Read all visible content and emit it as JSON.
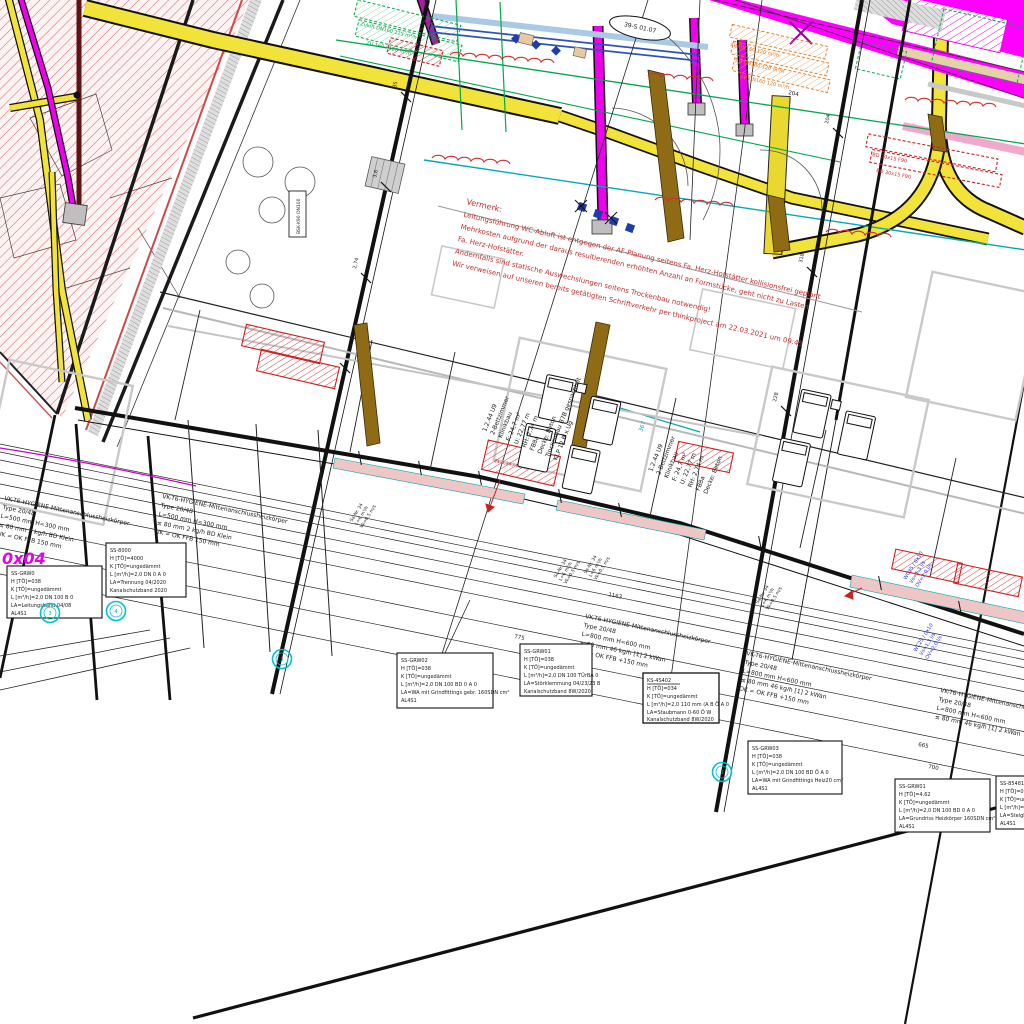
{
  "note": {
    "title": "Vermerk:",
    "lines": [
      "Leitungsführung WC-Abluft ist entgegen der AF-Planung seitens Fa. Herz-Hofstätter kollisionsfrei geplant",
      "Mehrkosten aufgrund der daraus resultierenden erhöhten Anzahl an Formstücke, geht nicht zu Lasten",
      "Fa. Herz-Hofstätter.",
      "Andernfalls sind statische Auswechslungen seitens Trockenbau notwendig!",
      "Wir verweisen auf unseren bereits getätigten Schriftverkehr per thinkproject am 22.03.2021 um 09:45"
    ]
  },
  "room_label": {
    "lines": [
      "1.2.44 U9",
      "2-Bettzimmer",
      "Klinikbau",
      "F: 24,7 m²",
      "U: 22,77 m",
      "RH: 2,74 m",
      "FB8a",
      "Decke: Beton",
      "Trockenbau B7B gespachtelt",
      "KLP 12 B x.Ug"
    ]
  },
  "radiator_spec": {
    "lines": [
      "VK-T6-HYGIENE-Mittenanschlussheizkörper",
      "Type 20/48",
      "L=800 mm H=600 mm",
      "≤ 80 mm  46 kg/h  [1] 2 kWan",
      "OK = OK FFB +150 mm"
    ]
  },
  "radiator_spec_alt": {
    "lines": [
      "VK-T6-HYGIENE-Mittenanschlussheizkörper",
      "Type 20/48",
      "L=500 mm H=300 mm",
      "≤ 80 mm  2 kg/h  BD Klein",
      "UK = OK FFB 150 mm"
    ]
  },
  "callouts": [
    {
      "lines": [
        "SS-GRW02",
        "H [TÖ]=038",
        "K [TÖ]=ungedämmt",
        "L [m³/h]=2,0 DN 100 BD 0 A 0",
        "LA=WA mit Grindfittings gebr. 160SDN cm²",
        "AL4S1"
      ]
    },
    {
      "lines": [
        "SS-GRW01",
        "H [TÖ]=038",
        "K [TÖ]=ungedämmt",
        "L [m³/h]=2,0 DN 100 TÜrBA 0",
        "LA=Störklemmung 04/23/23 B",
        "Kanalschutzband 8W/2020"
      ]
    },
    {
      "lines": [
        "KS-4S402",
        "H [TÖ]=034",
        "K [TÖ]=ungedämmt",
        "L [m³/h]=2,0 110 mm (A B Ö A 0",
        "LA=Staubmann 0-60 Ö W",
        "Kanalschutzband 8W/2020"
      ]
    },
    {
      "lines": [
        "SS-GRW03",
        "H [TÖ]=038",
        "K [TÖ]=ungedämmt",
        "L [m³/h]=2,0 DN 100 BD Ö A 0",
        "LA=WA mit Grindfittings Heiz20 cm²",
        "AL4S1"
      ]
    },
    {
      "lines": [
        "SS-GRW01",
        "H [TÖ]=4,62",
        "K [TÖ]=ungedämmt",
        "L [m³/h]=2,0 DN 100 BD 0 A 0",
        "LA=Grundriss Heizkörper 160SDN cm²",
        "AL4S1"
      ]
    },
    {
      "lines": [
        "SS-85481",
        "H [TÖ]=032",
        "K [TÖ]=ungedämmt",
        "L [m³/h]=2,0 DN 100 BD 0 A 0",
        "LA=Steigleitung Heizkörper 160 cm²",
        "AL4S1"
      ]
    },
    {
      "lines": [
        "SS-GRW0",
        "H [TÖ]=038",
        "K [TÖ]=ungedämmt",
        "L [m³/h]=2,0 DN 100 B 0",
        "LA=Leitungsband 04/08",
        "AL4S1"
      ]
    },
    {
      "lines": [
        "SS-8000",
        "H [TÖ]=4000",
        "K [TÖ]=ungedämmt",
        "L [m³/h]=2,0 DN 0 A 0",
        "LA=Trennung 04/2020",
        "Kanalschutzband 2020"
      ]
    }
  ],
  "flow_tag": {
    "lines": [
      "Sa-Nr. 34",
      "L=6 m³/h",
      "Vk=0,5 m/s"
    ]
  },
  "blue_note": {
    "lines": [
      "WC25 / 0x10",
      "Vs=1,3 l/s",
      "OV=2,0 l/s"
    ]
  },
  "labels": {
    "grid_bubble": "39-S 01.07",
    "riser": "0x04",
    "bsk": "BSK-K90 DN100",
    "green_tag_1": "Zuluft DN160 125 m³/h",
    "green_tag_2": "ZU 160 / 120 m³/h",
    "orange_tag": "AB DN160 120 m³/h",
    "red_tag": "21-0,34 / 60/40",
    "red_tag_2": "BD 30x15 F90",
    "teal_dim": "367"
  },
  "dims": {
    "a": "77",
    "b": "204",
    "c": "318",
    "d": "3,6",
    "e": "228",
    "f": "775",
    "g": "665",
    "h": "700",
    "i": "1163",
    "j": "35",
    "k": "2,74"
  },
  "bubbles": [
    "3",
    "4",
    "3",
    "5"
  ],
  "colors": {
    "duct_supply_yellow": "#f2e33a",
    "pipe_magenta": "#ff00ff",
    "note_red": "#c03030",
    "hatch_pink": "#d96b6b",
    "beam_brown": "#8f6b16",
    "marker_cyan": "#00c2ce",
    "line_green": "#00a84c",
    "line_blue": "#2e52b8"
  }
}
